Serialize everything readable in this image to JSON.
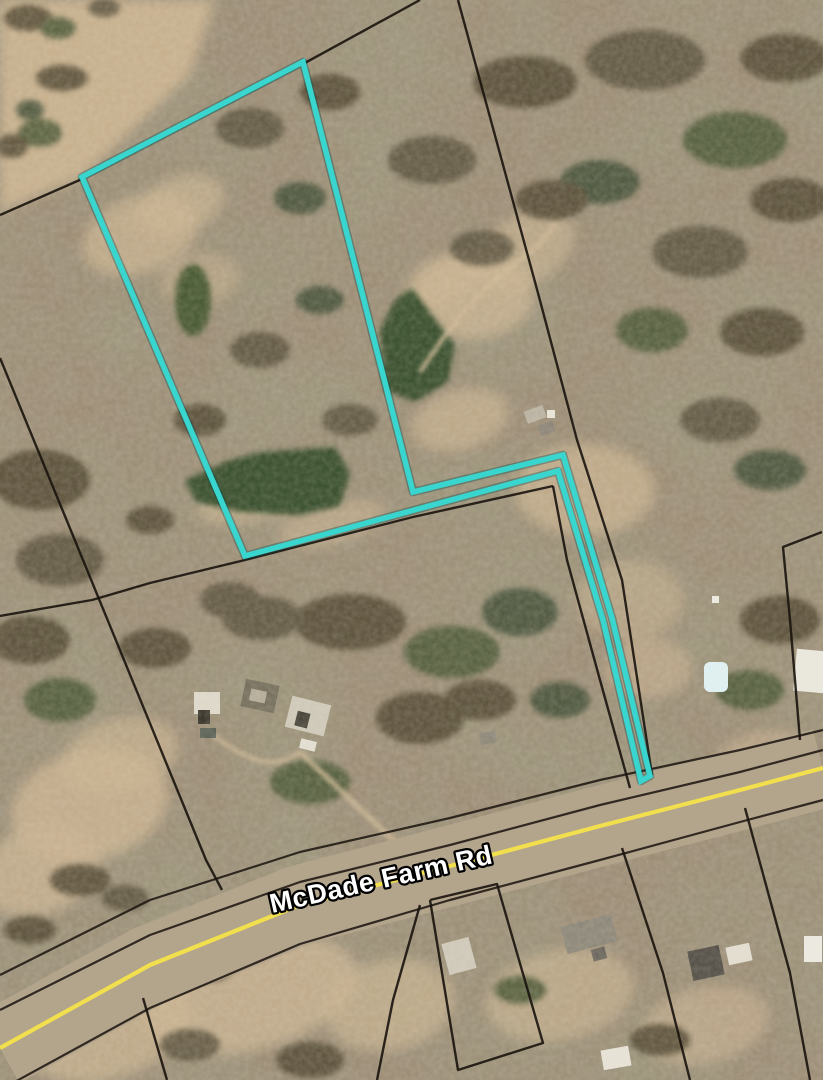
{
  "map": {
    "description": "Aerial parcel map with highlighted flag-shaped parcel",
    "road_label": "McDade Farm Rd",
    "colors": {
      "highlight": "#38d6cf",
      "highlight_shadow": "rgba(0,70,70,0.35)",
      "boundary": "#1a140e",
      "road_surface": "#b3a48c",
      "road_centerline": "#f2df4e",
      "label_text": "#ffffff",
      "label_outline": "#000000"
    },
    "highlight_parcel": {
      "name": "subject-parcel-outline",
      "stroke_width": 5.5,
      "points": [
        [
          303,
          62
        ],
        [
          413,
          492
        ],
        [
          563,
          455
        ],
        [
          612,
          618
        ],
        [
          650,
          776
        ],
        [
          641,
          781
        ],
        [
          603,
          620
        ],
        [
          558,
          471
        ],
        [
          245,
          556
        ],
        [
          82,
          177
        ]
      ]
    },
    "boundary_lines": [
      {
        "id": "north-boundary",
        "points": [
          [
            0,
            215
          ],
          [
            82,
            179
          ],
          [
            303,
            64
          ],
          [
            420,
            0
          ]
        ]
      },
      {
        "id": "northeast-long-boundary",
        "points": [
          [
            458,
            0
          ],
          [
            538,
            293
          ],
          [
            577,
            440
          ],
          [
            622,
            580
          ],
          [
            652,
            775
          ]
        ]
      },
      {
        "id": "middle-parcel-north",
        "points": [
          [
            0,
            616
          ],
          [
            92,
            600
          ],
          [
            150,
            583
          ],
          [
            245,
            560
          ],
          [
            413,
            517
          ],
          [
            553,
            486
          ]
        ]
      },
      {
        "id": "middle-parcel-west",
        "points": [
          [
            0,
            358
          ],
          [
            83,
            560
          ],
          [
            206,
            860
          ],
          [
            222,
            890
          ]
        ]
      },
      {
        "id": "middle-parcel-east",
        "points": [
          [
            553,
            486
          ],
          [
            567,
            560
          ],
          [
            600,
            680
          ],
          [
            630,
            788
          ]
        ]
      },
      {
        "id": "right-parcel-boundary",
        "points": [
          [
            822,
            532
          ],
          [
            783,
            547
          ],
          [
            790,
            620
          ],
          [
            800,
            740
          ]
        ]
      },
      {
        "id": "south-line-1",
        "points": [
          [
            420,
            905
          ],
          [
            393,
            1000
          ],
          [
            377,
            1080
          ]
        ]
      },
      {
        "id": "south-parcel",
        "points": [
          [
            430,
            900
          ],
          [
            497,
            884
          ],
          [
            543,
            1043
          ],
          [
            458,
            1070
          ],
          [
            430,
            900
          ]
        ]
      },
      {
        "id": "south-line-2",
        "points": [
          [
            622,
            848
          ],
          [
            663,
            973
          ],
          [
            690,
            1080
          ]
        ]
      },
      {
        "id": "south-line-3",
        "points": [
          [
            745,
            808
          ],
          [
            790,
            973
          ],
          [
            810,
            1080
          ]
        ]
      },
      {
        "id": "south-line-4",
        "points": [
          [
            143,
            998
          ],
          [
            167,
            1080
          ]
        ]
      }
    ],
    "road": {
      "centerline": [
        [
          0,
          1048
        ],
        [
          150,
          965
        ],
        [
          300,
          905
        ],
        [
          450,
          866
        ],
        [
          600,
          826
        ],
        [
          740,
          790
        ],
        [
          823,
          768
        ]
      ],
      "edges": [
        [
          [
            0,
            975
          ],
          [
            150,
            900
          ],
          [
            300,
            852
          ],
          [
            450,
            818
          ],
          [
            600,
            780
          ],
          [
            740,
            750
          ],
          [
            823,
            730
          ]
        ],
        [
          [
            0,
            1010
          ],
          [
            150,
            935
          ],
          [
            300,
            882
          ],
          [
            450,
            845
          ],
          [
            600,
            805
          ],
          [
            740,
            772
          ],
          [
            823,
            750
          ]
        ],
        [
          [
            0,
            1090
          ],
          [
            150,
            1008
          ],
          [
            300,
            944
          ],
          [
            450,
            900
          ],
          [
            600,
            860
          ],
          [
            740,
            822
          ],
          [
            823,
            800
          ]
        ]
      ],
      "surface_width": 80,
      "label_x": 383,
      "label_y": 888,
      "label_angle": -12.7,
      "label_font_size": 27
    }
  }
}
